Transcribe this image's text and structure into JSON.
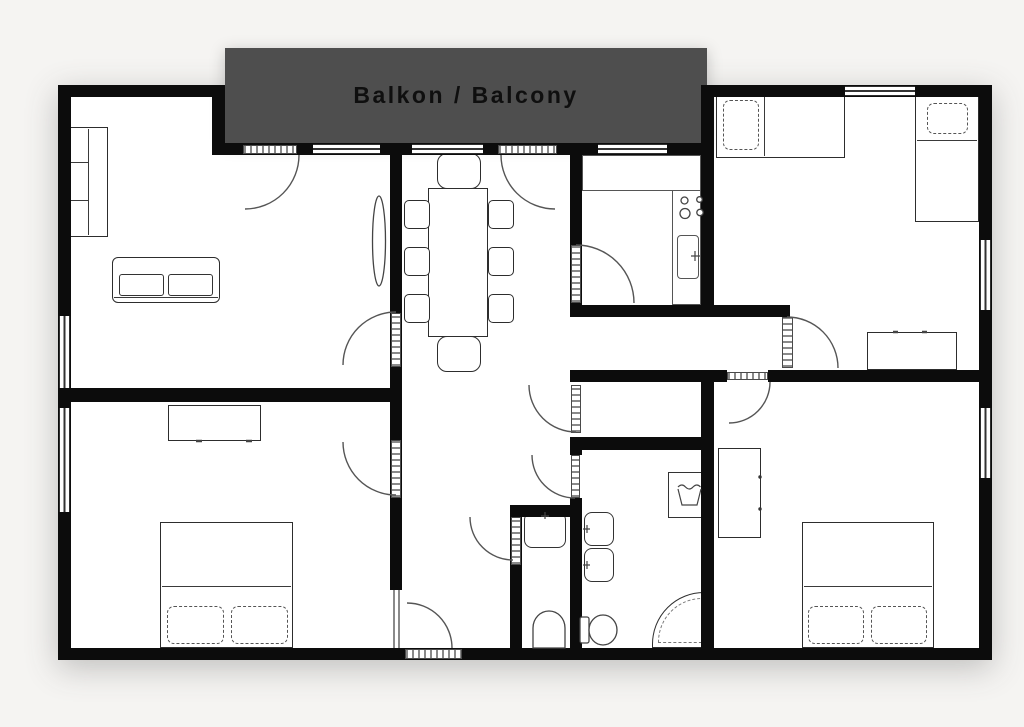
{
  "balcony": {
    "label": "Balkon / Balcony"
  },
  "colors": {
    "page_background": "#f5f4f2",
    "floor_fill": "#ffffff",
    "wall": "#0c0c0c",
    "balcony_fill": "#4e4e4e",
    "balcony_text": "#0f0f0f",
    "door_arc": "#555555",
    "furniture_stroke": "#2d2d2d"
  },
  "plan": {
    "type": "apartment-floor-plan",
    "rooms": [
      {
        "name": "living-room",
        "furniture": [
          "shelf-cabinet",
          "sofa",
          "tv"
        ]
      },
      {
        "name": "dining-area",
        "furniture": [
          "dining-table",
          "8-chairs"
        ]
      },
      {
        "name": "kitchen",
        "furniture": [
          "counter",
          "stove-4-burners",
          "sink"
        ]
      },
      {
        "name": "bedroom-top-right",
        "furniture": [
          "single-bed",
          "single-bed",
          "sideboard"
        ]
      },
      {
        "name": "bedroom-bottom-right",
        "furniture": [
          "double-bed",
          "wardrobe"
        ]
      },
      {
        "name": "bedroom-bottom-left",
        "furniture": [
          "double-bed",
          "dresser"
        ]
      },
      {
        "name": "bathroom",
        "furniture": [
          "sink",
          "sink",
          "toilet",
          "washing-machine",
          "corner-shower"
        ]
      },
      {
        "name": "wc",
        "furniture": [
          "sink",
          "toilet"
        ]
      },
      {
        "name": "hallway",
        "furniture": []
      },
      {
        "name": "closet",
        "furniture": []
      },
      {
        "name": "balcony",
        "furniture": []
      }
    ],
    "door_count": 12,
    "window_count": 8
  }
}
